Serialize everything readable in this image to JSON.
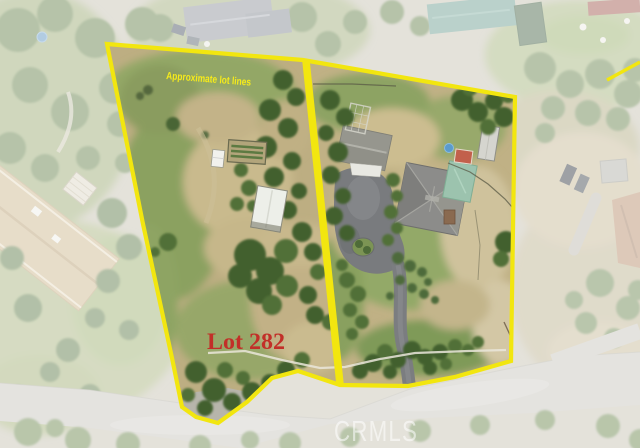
{
  "annotations": {
    "lot_lines_label": "Approximate lot lines",
    "lot_label": "Lot 282",
    "watermark": "CRMLS"
  },
  "colors": {
    "boundary_yellow": "#f2e60f",
    "label_text_yellow": "#f6eb1a",
    "lot_label_red": "#c22f28",
    "watermark_white": "rgba(255,255,255,0.55)"
  }
}
